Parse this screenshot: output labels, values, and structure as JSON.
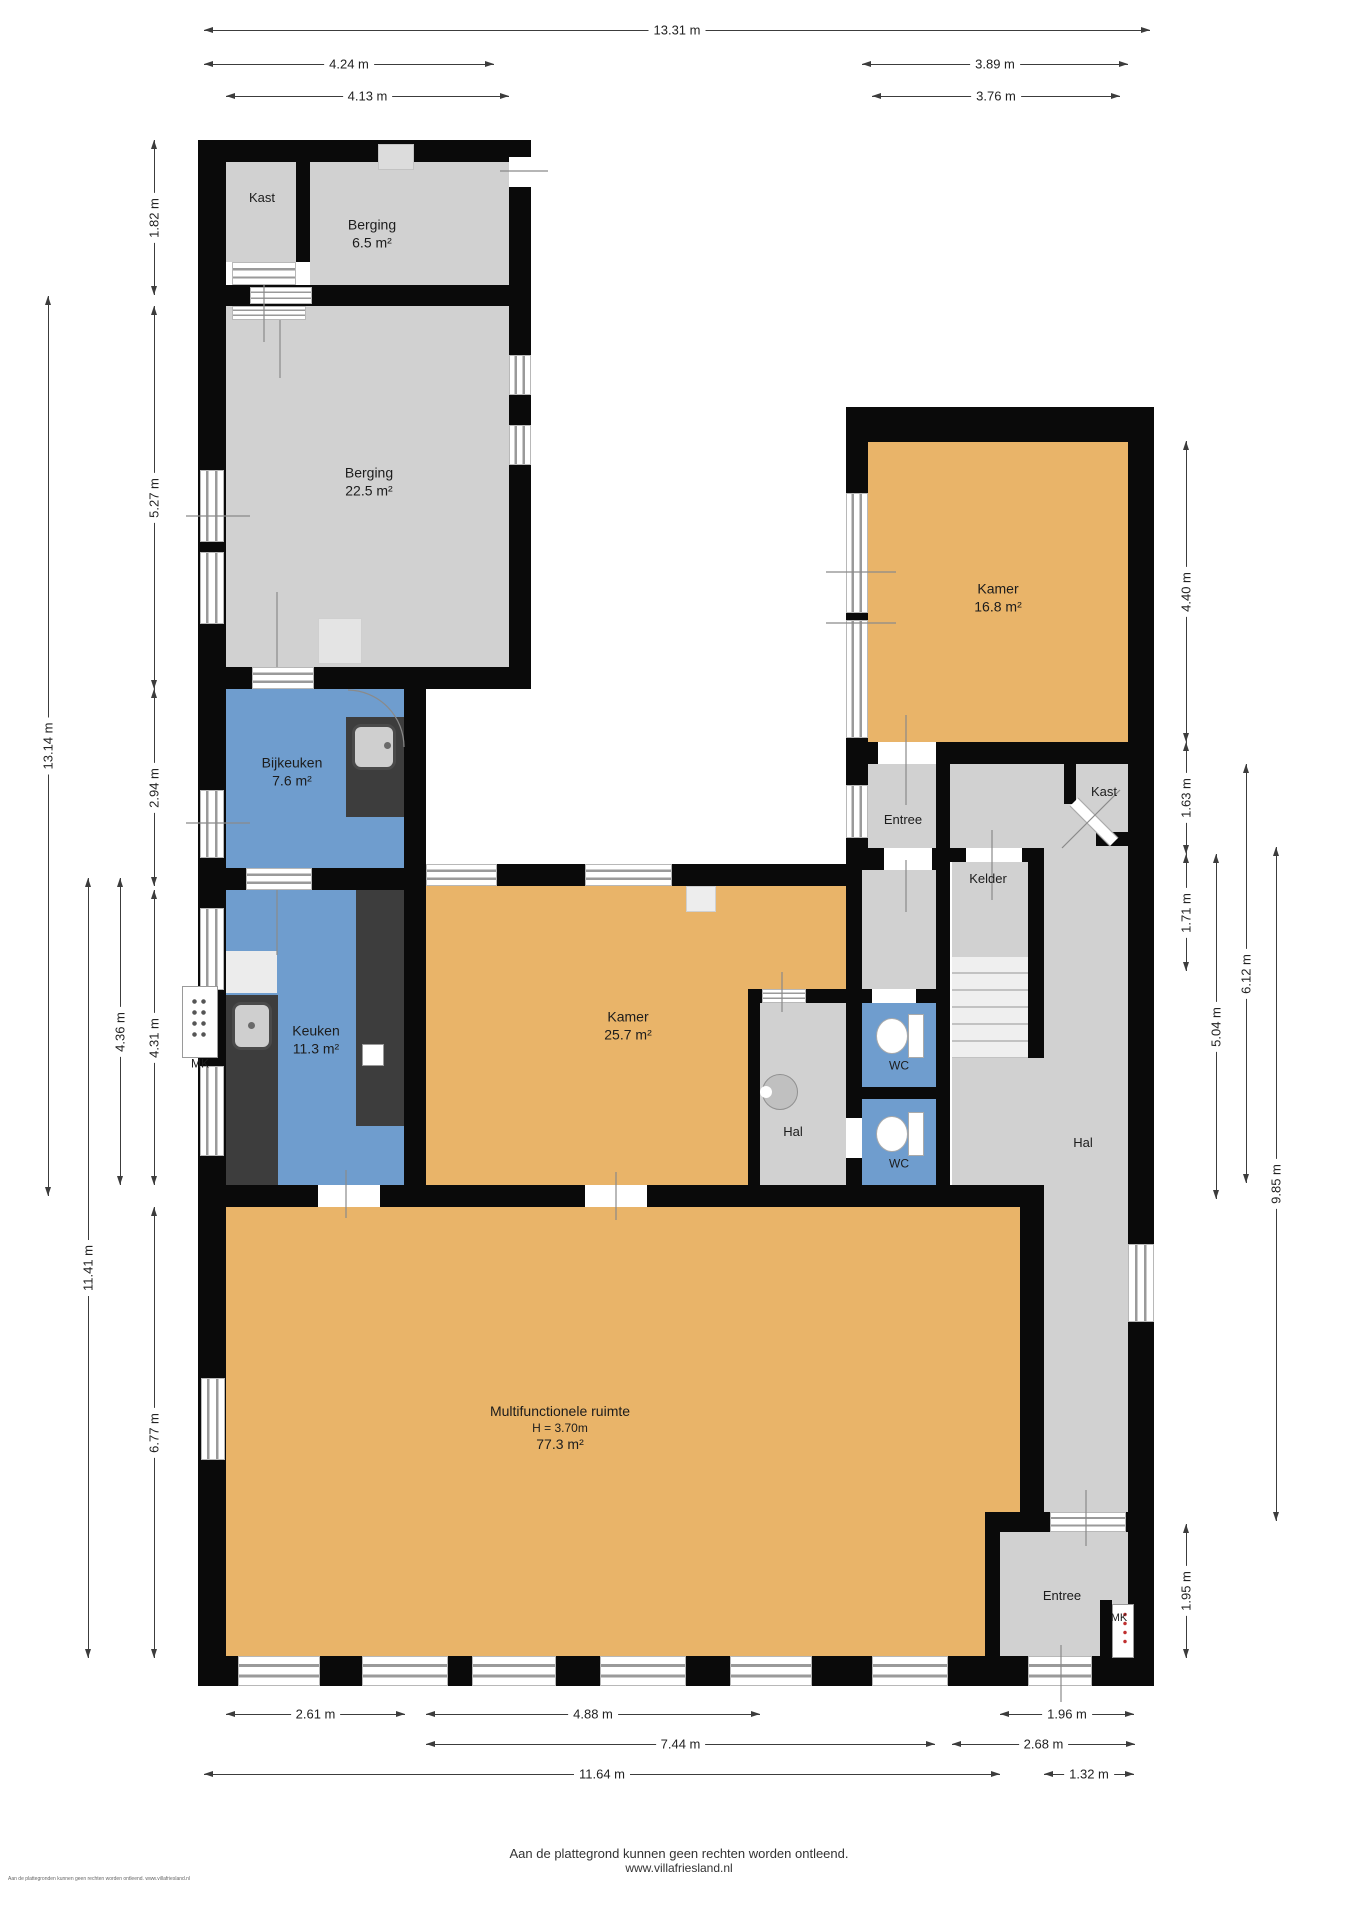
{
  "title": "Plattegrond begane grond",
  "footer": {
    "line1": "Aan de plattegrond kunnen geen rechten worden ontleend.",
    "line2": "www.villafriesland.nl",
    "corner": "Aan de plattegronden kunnen geen rechten worden ontleend. www.villafriesland.nl"
  },
  "colors": {
    "wall": "#0a0a0a",
    "room_gray": "#d1d1d1",
    "room_orange": "#e9b469",
    "room_blue": "#6f9dce",
    "counter_dark": "#3d3d3d",
    "stairs": "#efefef",
    "dim_line": "#3c3c3c"
  },
  "rooms": [
    {
      "id": "kast-top",
      "lines": [
        "Kast"
      ],
      "x": 262,
      "y": 198,
      "size": 13
    },
    {
      "id": "berging-klein",
      "lines": [
        "Berging",
        "6.5 m²"
      ],
      "x": 372,
      "y": 234,
      "size": 14
    },
    {
      "id": "berging-groot",
      "lines": [
        "Berging",
        "22.5 m²"
      ],
      "x": 369,
      "y": 482,
      "size": 14
    },
    {
      "id": "bijkeuken",
      "lines": [
        "Bijkeuken",
        "7.6 m²"
      ],
      "x": 292,
      "y": 772,
      "size": 14
    },
    {
      "id": "keuken",
      "lines": [
        "Keuken",
        "11.3 m²"
      ],
      "x": 316,
      "y": 1040,
      "size": 14
    },
    {
      "id": "kamer-groot",
      "lines": [
        "Kamer",
        "25.7 m²"
      ],
      "x": 628,
      "y": 1026,
      "size": 14
    },
    {
      "id": "hal-midden",
      "lines": [
        "Hal"
      ],
      "x": 793,
      "y": 1132,
      "size": 13
    },
    {
      "id": "wc-boven",
      "lines": [
        "WC"
      ],
      "x": 899,
      "y": 1066,
      "size": 12
    },
    {
      "id": "wc-onder",
      "lines": [
        "WC"
      ],
      "x": 899,
      "y": 1164,
      "size": 12
    },
    {
      "id": "kamer-rechts",
      "lines": [
        "Kamer",
        "16.8 m²"
      ],
      "x": 998,
      "y": 598,
      "size": 14
    },
    {
      "id": "entree-rechts",
      "lines": [
        "Entree"
      ],
      "x": 903,
      "y": 820,
      "size": 13
    },
    {
      "id": "kast-rechts",
      "lines": [
        "Kast"
      ],
      "x": 1104,
      "y": 792,
      "size": 13
    },
    {
      "id": "kelder",
      "lines": [
        "Kelder"
      ],
      "x": 988,
      "y": 879,
      "size": 13
    },
    {
      "id": "hal-rechts",
      "lines": [
        "Hal"
      ],
      "x": 1083,
      "y": 1143,
      "size": 13
    },
    {
      "id": "multifunctionele-ruimte",
      "lines": [
        "Multifunctionele ruimte",
        "H = 3.70m",
        "77.3 m²"
      ],
      "x": 560,
      "y": 1428,
      "size": 14
    },
    {
      "id": "entree-beneden",
      "lines": [
        "Entree"
      ],
      "x": 1062,
      "y": 1596,
      "size": 13
    },
    {
      "id": "mk-links",
      "lines": [
        "MK"
      ],
      "x": 200,
      "y": 1064,
      "size": 12
    },
    {
      "id": "mk-beneden",
      "lines": [
        "MK"
      ],
      "x": 1119,
      "y": 1619,
      "size": 11
    }
  ],
  "dimensions": {
    "top": [
      {
        "label": "13.31 m",
        "x1": 204,
        "x2": 1150,
        "y": 30
      },
      {
        "label": "4.24 m",
        "x1": 204,
        "x2": 494,
        "y": 64
      },
      {
        "label": "3.89 m",
        "x1": 862,
        "x2": 1128,
        "y": 64
      },
      {
        "label": "4.13 m",
        "x1": 226,
        "x2": 509,
        "y": 96
      },
      {
        "label": "3.76 m",
        "x1": 872,
        "x2": 1120,
        "y": 96
      }
    ],
    "left": [
      {
        "label": "13.14 m",
        "x": 48,
        "y1": 296,
        "y2": 1196
      },
      {
        "label": "11.41 m",
        "x": 88,
        "y1": 878,
        "y2": 1658
      },
      {
        "label": "4.36 m",
        "x": 120,
        "y1": 878,
        "y2": 1185
      },
      {
        "label": "1.82 m",
        "x": 154,
        "y1": 140,
        "y2": 295
      },
      {
        "label": "5.27 m",
        "x": 154,
        "y1": 306,
        "y2": 689
      },
      {
        "label": "2.94 m",
        "x": 154,
        "y1": 689,
        "y2": 886
      },
      {
        "label": "4.31 m",
        "x": 154,
        "y1": 890,
        "y2": 1185
      },
      {
        "label": "6.77 m",
        "x": 154,
        "y1": 1207,
        "y2": 1658
      }
    ],
    "right": [
      {
        "label": "4.40 m",
        "x": 1186,
        "y1": 441,
        "y2": 742
      },
      {
        "label": "1.63 m",
        "x": 1186,
        "y1": 742,
        "y2": 854
      },
      {
        "label": "1.71 m",
        "x": 1186,
        "y1": 854,
        "y2": 971
      },
      {
        "label": "1.95 m",
        "x": 1186,
        "y1": 1524,
        "y2": 1658
      },
      {
        "label": "5.04 m",
        "x": 1216,
        "y1": 854,
        "y2": 1199
      },
      {
        "label": "6.12 m",
        "x": 1246,
        "y1": 764,
        "y2": 1183
      },
      {
        "label": "9.85 m",
        "x": 1276,
        "y1": 847,
        "y2": 1521
      }
    ],
    "bottom": [
      {
        "label": "2.61 m",
        "x1": 226,
        "x2": 405,
        "y": 1714
      },
      {
        "label": "4.88 m",
        "x1": 426,
        "x2": 760,
        "y": 1714
      },
      {
        "label": "1.96 m",
        "x1": 1000,
        "x2": 1134,
        "y": 1714
      },
      {
        "label": "7.44 m",
        "x1": 426,
        "x2": 935,
        "y": 1744
      },
      {
        "label": "2.68 m",
        "x1": 952,
        "x2": 1135,
        "y": 1744
      },
      {
        "label": "11.64 m",
        "x1": 204,
        "x2": 1000,
        "y": 1774
      },
      {
        "label": "1.32 m",
        "x1": 1044,
        "x2": 1134,
        "y": 1774
      }
    ]
  }
}
